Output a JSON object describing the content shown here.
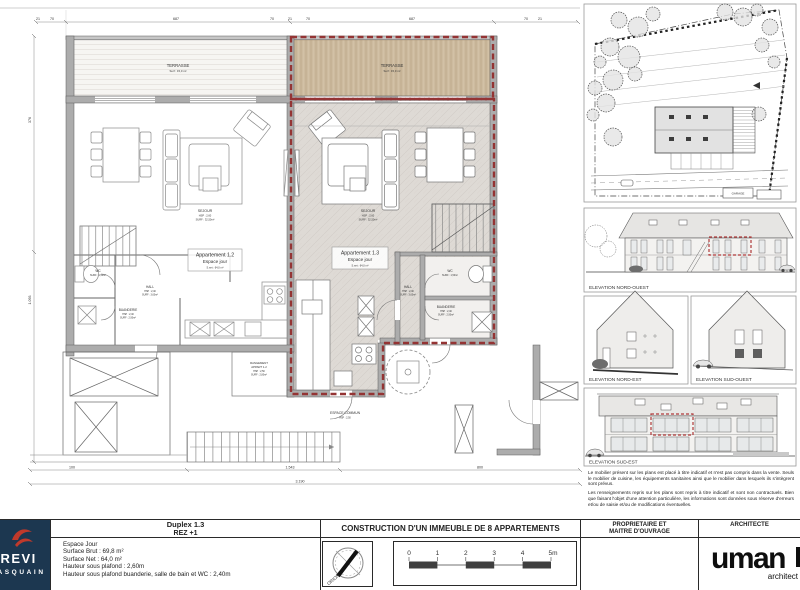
{
  "colors": {
    "accent_red": "#943434",
    "wall_grey": "#acacac",
    "floor_grey": "#dedad5",
    "wood_tan": "#cdbb9f",
    "logo_navy": "#1c3750",
    "logo_red": "#c0392b"
  },
  "plan": {
    "labels": {
      "terrasse_left": {
        "title": "TERRASSE",
        "sub": "Surf : 15,0 m²"
      },
      "terrasse_right": {
        "title": "TERRASSE",
        "sub": "Surf : 15,0 m²"
      },
      "apt12": {
        "line1": "Appartement 1.2",
        "line2": "Espace jour",
        "line3": "S.net : 64,0 m²"
      },
      "apt13": {
        "line1": "Appartement 1.3",
        "line2": "Espace jour",
        "line3": "S.net : 64,0 m²"
      },
      "sejour12": {
        "title": "SEJOUR",
        "sub1": "HSP : 2,60",
        "sub2": "SURF : 32,50m²"
      },
      "sejour13": {
        "title": "SEJOUR",
        "sub1": "HSP : 2,60",
        "sub2": "SURF : 32,50m²"
      },
      "wc12": {
        "title": "WC",
        "sub": "SURF : 1,50m²"
      },
      "wc13": {
        "title": "WC",
        "sub": "SURF : 1,50m²"
      },
      "hall12": {
        "title": "HALL",
        "sub1": "HSP : 2,40",
        "sub2": "SURF : 3,60m²"
      },
      "hall13": {
        "title": "HALL",
        "sub1": "HSP : 2,40",
        "sub2": "SURF : 3,60m²"
      },
      "buanderie12": {
        "title": "BUANDERIE",
        "sub1": "HSP : 2,40",
        "sub2": "SURF : 2,90m²"
      },
      "buanderie13": {
        "title": "BUANDERIE",
        "sub1": "HSP : 2,40",
        "sub2": "SURF : 2,90m²"
      },
      "espace_commun": {
        "title": "ESPACE COMMUN",
        "sub": "HSP : 2,50"
      },
      "rangement12": {
        "line1": "RANGEMENT",
        "line2": "APPART 1.2",
        "line3": "HSP : 2,50",
        "line4": "SURF : 2,80m²"
      }
    },
    "dims": {
      "top": [
        "21",
        "70",
        "687",
        "70",
        "21",
        "70",
        "687",
        "70",
        "21"
      ],
      "bottom1": [
        "100",
        "1.543",
        "800"
      ],
      "bottom2": [
        "3.190"
      ],
      "left": [
        "376",
        "1.093"
      ]
    }
  },
  "site_plan": {
    "garage_label": "GARAGE"
  },
  "elevations": {
    "nord_ouest": "ELEVATION NORD-OUEST",
    "nord_est": "ELEVATION NORD-EST",
    "sud_ouest": "ELEVATION SUD-OUEST",
    "sud_est": "ELEVATION SUD-EST"
  },
  "disclaimer": {
    "p1": "Le mobilier présent sur les plans est placé à titre indicatif et n'est pas compris dans la vente. Seuls le mobilier de cuisine, les équipements sanitaires ainsi que le mobilier dans lesquels ils s'intègrent sont prévus.",
    "p2": "Les renseignements repris sur les plans sont repris à titre indicatif et sont non contractuels. Bien que faisant l'objet d'une attention particulière, les informations sont données sous réserve d'erreurs et/ou de saisie et/ou de modifications éventuelles."
  },
  "titleblock": {
    "logo": {
      "line1": "TREVI",
      "line2": "PASQUAIN"
    },
    "sheet_title1": "Duplex 1.3",
    "sheet_title2": "REZ +1",
    "info_lines": [
      "Espace Jour",
      "Surface Brut : 69,8 m²",
      "Surface Net : 64,0 m²",
      "Hauteur sous plafond : 2,60m",
      "Hauteur sous plafond buanderie, salle de bain et WC : 2,40m"
    ],
    "project_title": "CONSTRUCTION D'UN IMMEUBLE DE 8 APPARTEMENTS",
    "scale_ticks": [
      "0",
      "1",
      "2",
      "3",
      "4",
      "5m"
    ],
    "compass_label": "ORION",
    "owner_header1": "PROPRIETAIRE ET",
    "owner_header2": "MAITRE D'OUVRAGE",
    "architect_header": "ARCHITECTE",
    "architect_logo": "uman",
    "architect_logo_sub": "architect"
  }
}
